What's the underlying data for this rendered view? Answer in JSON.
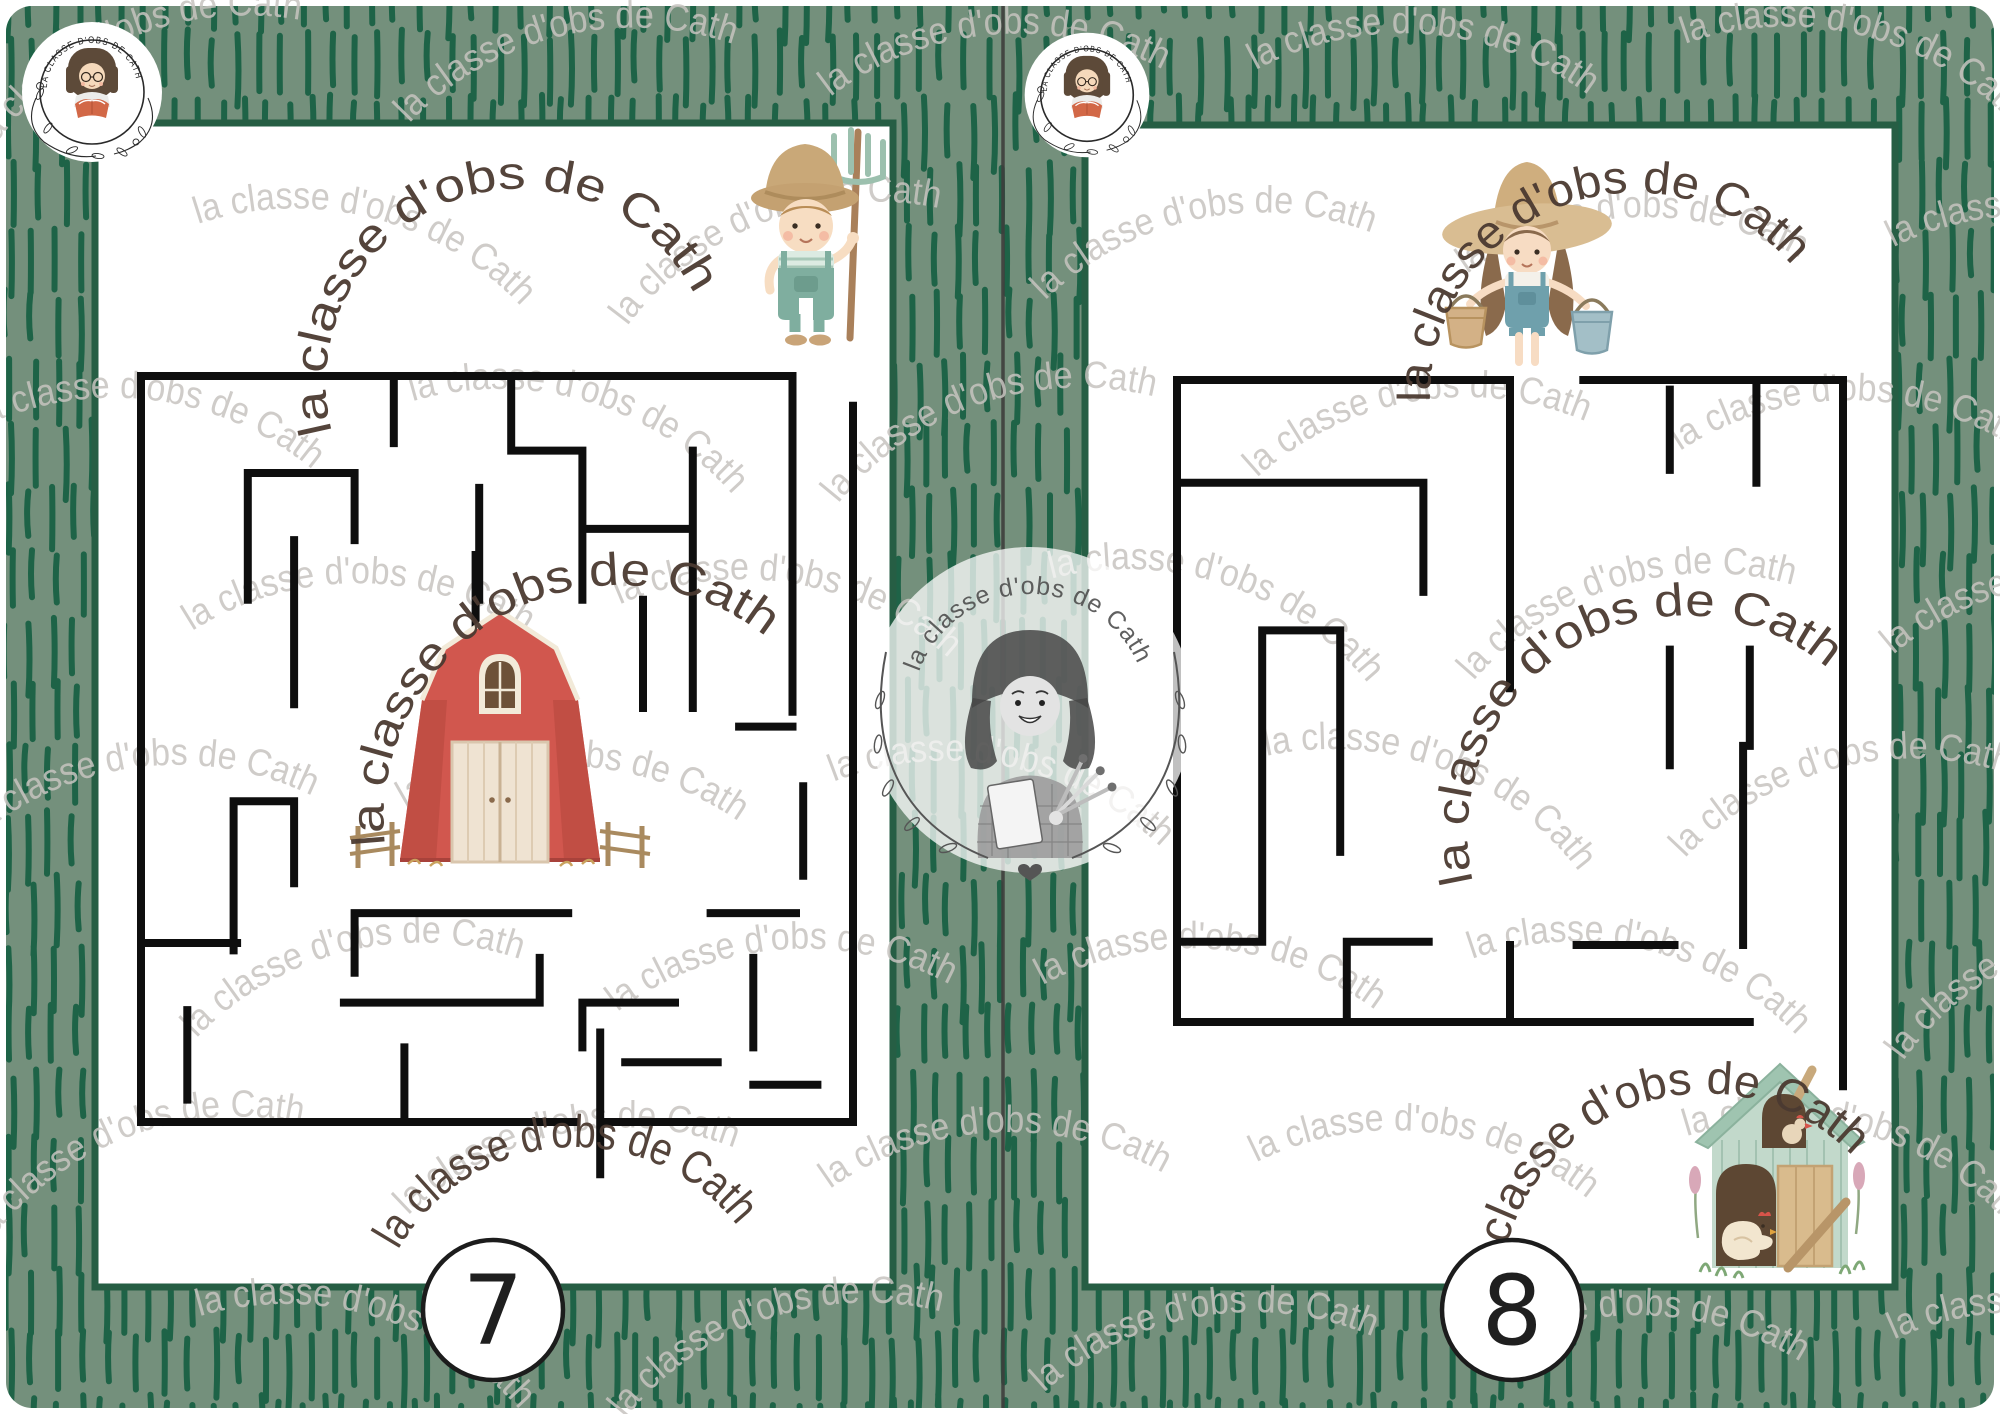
{
  "document": {
    "type": "printable-maze-worksheets",
    "pages_visible": 2
  },
  "brand": {
    "badge_text": "LA CLASSE D'OBS DE CATH",
    "watermark_phrase": "la classe d'obs de Cath",
    "center_badge_phrase": "la classe d'obs de Cath"
  },
  "colors": {
    "sheet_green": "#74907c",
    "grass_dash_green": "#196144",
    "page_border_green": "#265e44",
    "divider_gray": "#3e3e3c",
    "maze_wall_black": "#0e0e0e",
    "watermark_gray": "#c7c4c0",
    "watermark_dark_brown": "#4b3a31",
    "page_white": "#ffffff"
  },
  "pages": [
    {
      "number": "7",
      "start_marker": "farmer-boy-with-pitchfork",
      "goal_marker": "red-barn",
      "illustrations": [
        "farmer-boy-illustration",
        "red-barn-illustration"
      ],
      "maze": {
        "box": {
          "x": 141,
          "y": 376,
          "w": 712,
          "h": 746
        },
        "entrance": "top-right",
        "exit": "bottom-center",
        "walls": [
          [
            0,
            0,
            91.5,
            0
          ],
          [
            91.5,
            0,
            91.5,
            45
          ],
          [
            100,
            4,
            100,
            100
          ],
          [
            0,
            0,
            0,
            100
          ],
          [
            0,
            100,
            61,
            100
          ],
          [
            64.5,
            88,
            64.5,
            107
          ],
          [
            64.5,
            100,
            100,
            100
          ],
          [
            15,
            13,
            30,
            13
          ],
          [
            15,
            13,
            15,
            30
          ],
          [
            30,
            13,
            30,
            22
          ],
          [
            21.5,
            22,
            21.5,
            44
          ],
          [
            35.5,
            0,
            35.5,
            9
          ],
          [
            52,
            0,
            52,
            10
          ],
          [
            52,
            10,
            62,
            10
          ],
          [
            62,
            10,
            62,
            30
          ],
          [
            47.5,
            15,
            47.5,
            30
          ],
          [
            63,
            20.5,
            77.5,
            20.5
          ],
          [
            77.5,
            10,
            77.5,
            44.5
          ],
          [
            70.5,
            30,
            70.5,
            44.5
          ],
          [
            84,
            47,
            91.5,
            47
          ],
          [
            47,
            24,
            47,
            64
          ],
          [
            13,
            57,
            13,
            77
          ],
          [
            13,
            57,
            21.5,
            57
          ],
          [
            21.5,
            57,
            21.5,
            68
          ],
          [
            0,
            76,
            13.5,
            76
          ],
          [
            30,
            72,
            60,
            72
          ],
          [
            30,
            72,
            30,
            80
          ],
          [
            6.5,
            85,
            6.5,
            97
          ],
          [
            28.5,
            84,
            56,
            84
          ],
          [
            56,
            78,
            56,
            84
          ],
          [
            37,
            90,
            37,
            100
          ],
          [
            62,
            84,
            75,
            84
          ],
          [
            62,
            84,
            62,
            90
          ],
          [
            80,
            72,
            92,
            72
          ],
          [
            86,
            78,
            86,
            90
          ],
          [
            93,
            55,
            93,
            67
          ],
          [
            68,
            92,
            81,
            92
          ],
          [
            86,
            95,
            95,
            95
          ]
        ]
      }
    },
    {
      "number": "8",
      "start_marker": "farmer-girl-with-buckets",
      "goal_marker": "chicken-coop",
      "illustrations": [
        "farmer-girl-illustration",
        "chicken-coop-illustration"
      ],
      "maze": {
        "box": {
          "x": 1177,
          "y": 380,
          "w": 666,
          "h": 642
        },
        "entrance": "top-center",
        "exit": "bottom-right",
        "walls": [
          [
            0,
            0,
            50,
            0
          ],
          [
            61,
            0,
            100,
            0
          ],
          [
            0,
            0,
            0,
            100
          ],
          [
            100,
            0,
            100,
            110
          ],
          [
            0,
            100,
            86,
            100
          ],
          [
            50,
            0,
            50,
            48
          ],
          [
            74,
            1.5,
            74,
            14
          ],
          [
            87,
            0,
            87,
            16
          ],
          [
            0,
            16,
            37,
            16
          ],
          [
            37,
            16,
            37,
            33
          ],
          [
            12.8,
            39,
            12.8,
            87.5
          ],
          [
            12.8,
            39,
            24.5,
            39
          ],
          [
            24.5,
            39,
            24.5,
            73.5
          ],
          [
            74,
            42,
            74,
            60
          ],
          [
            86,
            42,
            86,
            57
          ],
          [
            0,
            87.5,
            12.8,
            87.5
          ],
          [
            25.5,
            87.5,
            37.8,
            87.5
          ],
          [
            25.5,
            87.5,
            25.5,
            100
          ],
          [
            50,
            88,
            50,
            100
          ],
          [
            60,
            88,
            74.7,
            88
          ],
          [
            85,
            57,
            85,
            88
          ]
        ]
      }
    }
  ]
}
